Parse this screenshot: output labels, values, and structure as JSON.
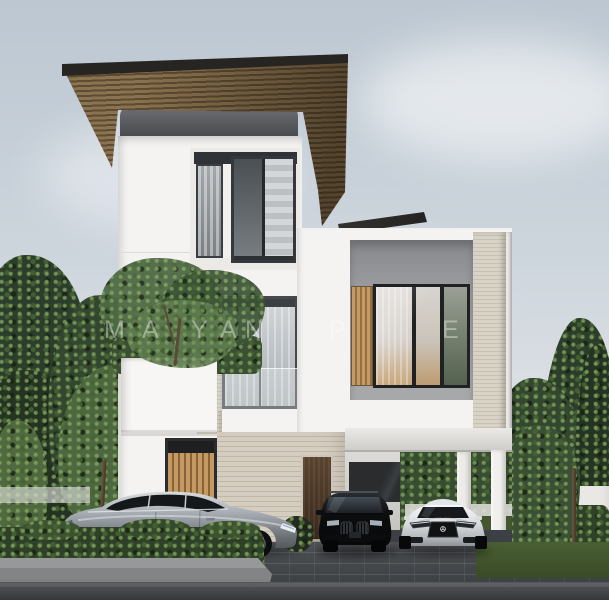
{
  "meta": {
    "scene_type": "3d architectural exterior render",
    "description": "Modern three-storey white villa with cantilevered timber-slat roof, dark framed glass windows, stone accents, balcony planter tree, carport and three parked cars on a paved driveway with hedges and trees"
  },
  "watermark": {
    "opacity": 0.38,
    "letters": [
      {
        "ch": "M",
        "x": 104
      },
      {
        "ch": "A",
        "x": 142
      },
      {
        "ch": "Y",
        "x": 191
      },
      {
        "ch": "A",
        "x": 220
      },
      {
        "ch": "N",
        "x": 245
      },
      {
        "ch": "P",
        "x": 329
      },
      {
        "ch": "E",
        "x": 442
      }
    ]
  },
  "palette": {
    "skyTop": "#bcc7d1",
    "skyMid": "#ccd4dc",
    "skyLow": "#dfe3e6",
    "wallWhite": "#f4f3f1",
    "wallShade": "#e5e4e1",
    "roofWood": "#8a7350",
    "roofWoodDark": "#5e4b31",
    "roofFascia": "#262522",
    "parapetTop": "#6e6f74",
    "parapetBottom": "#46474b",
    "stoneBeige": "#d5cec0",
    "stoneBeigeDark": "#c0b8a7",
    "limestone": "#d8d3c6",
    "limestoneDark": "#c7c1b2",
    "bayGray": "#96979a",
    "frameDark": "#26282b",
    "glassLight": "#c8ccd0",
    "glassDark": "#565b60",
    "curtain": "#dcdad6",
    "curtainWarm": "#c9a77c",
    "slatWood": "#c49a66",
    "slatWoodDark": "#95703f",
    "doorWood": "#4a3625",
    "hedge": "#2f4028",
    "hedgeLight": "#6f8f56",
    "treeDark": "#2c3d2b",
    "treeLight": "#4d6841",
    "grass": "#46582f",
    "fence": "#e9e8e5",
    "street": "#55575a",
    "streetDark": "#35373a",
    "curb": "#97989a",
    "paver": "#43464a",
    "paverLine": "#7e8388",
    "sedanSilver": "#a9afb5",
    "suvBlack": "#141518",
    "coupeWhite": "#eef0f2"
  }
}
